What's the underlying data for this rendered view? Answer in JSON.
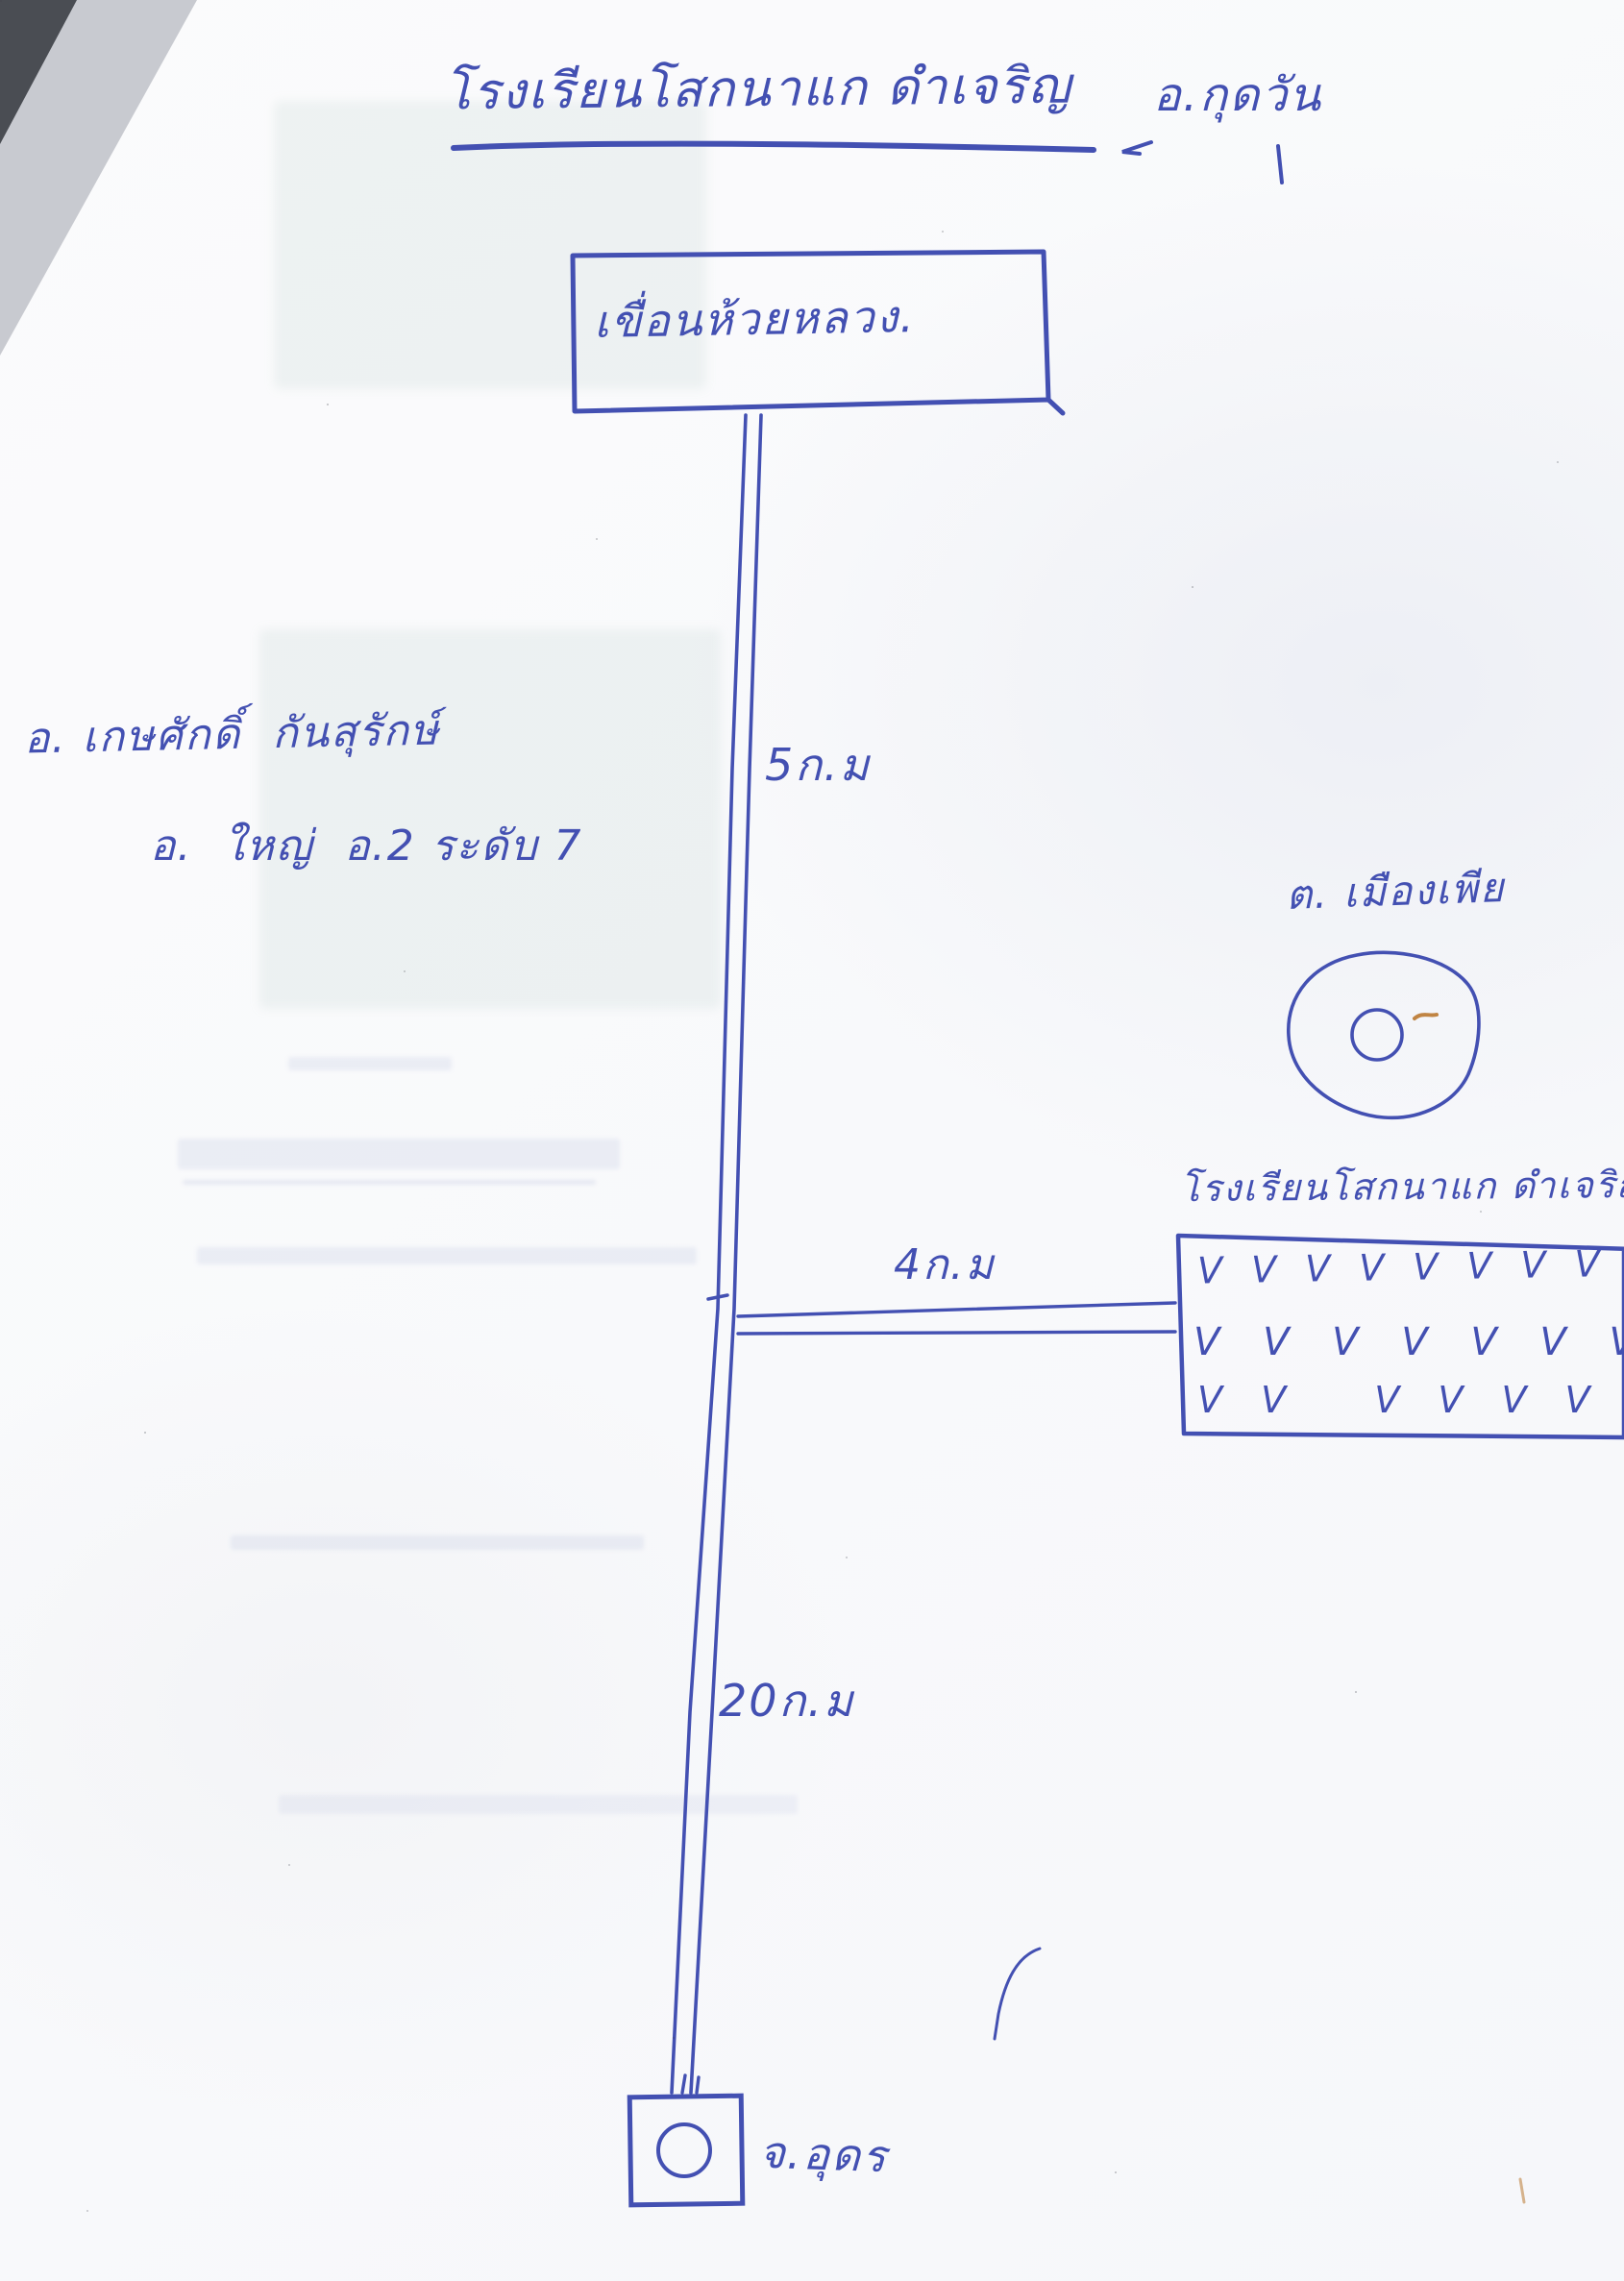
{
  "page": {
    "title": "โรงเรียนโสกนาแก ดำเจริญ",
    "title_district": "อ.กุดวัน"
  },
  "map": {
    "dam_box_label": "เขื่อนห้วยหลวง.",
    "teacher_note_line1": "อ. เกษศักดิ์  กันสุรักษ์",
    "teacher_note_line2": "อ.  ใหญ่  อ.2 ระดับ 7",
    "distance_top": "5ก.ม",
    "distance_branch": "4ก.ม",
    "distance_bottom": "20ก.ม",
    "village_label": "ต. เมืองเพีย",
    "school_label": "โรงเรียนโสกนาแก ดำเจริญ",
    "school_field_rows": [
      "V V V V V V V V V V V V V V V V",
      "V V V V V V V V V V V V",
      "V V   V V V V V V V V V"
    ],
    "province_label": "จ.อุดร"
  },
  "colors": {
    "pen_blue": "#4350b2",
    "accent_orange": "#c08443",
    "paper": "#fbfbfc",
    "corner_dark": "#4a4d53"
  }
}
